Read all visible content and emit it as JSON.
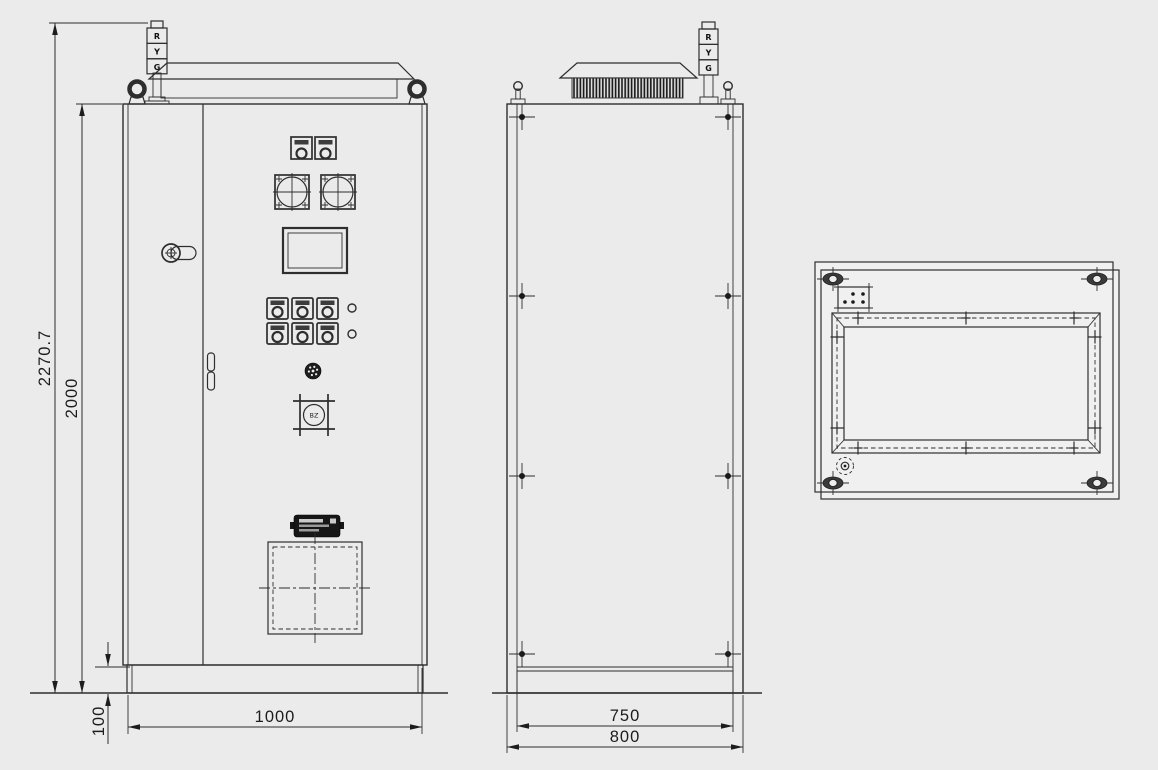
{
  "drawing": {
    "colors": {
      "background": "#ebebeb",
      "panel": "#f0f0f0",
      "line": "#2e2e2e",
      "hatch": "#1c1c1c",
      "nameplate": "#161616"
    },
    "signal_tower": {
      "segments": [
        "R",
        "Y",
        "G"
      ]
    },
    "buzzer": {
      "label": "BZ"
    },
    "dimensions": {
      "overall_height": "2270.7",
      "cabinet_height": "2000",
      "plinth_height": "100",
      "cabinet_width": "1000",
      "plinth_depth": "750",
      "cabinet_depth": "800"
    }
  }
}
